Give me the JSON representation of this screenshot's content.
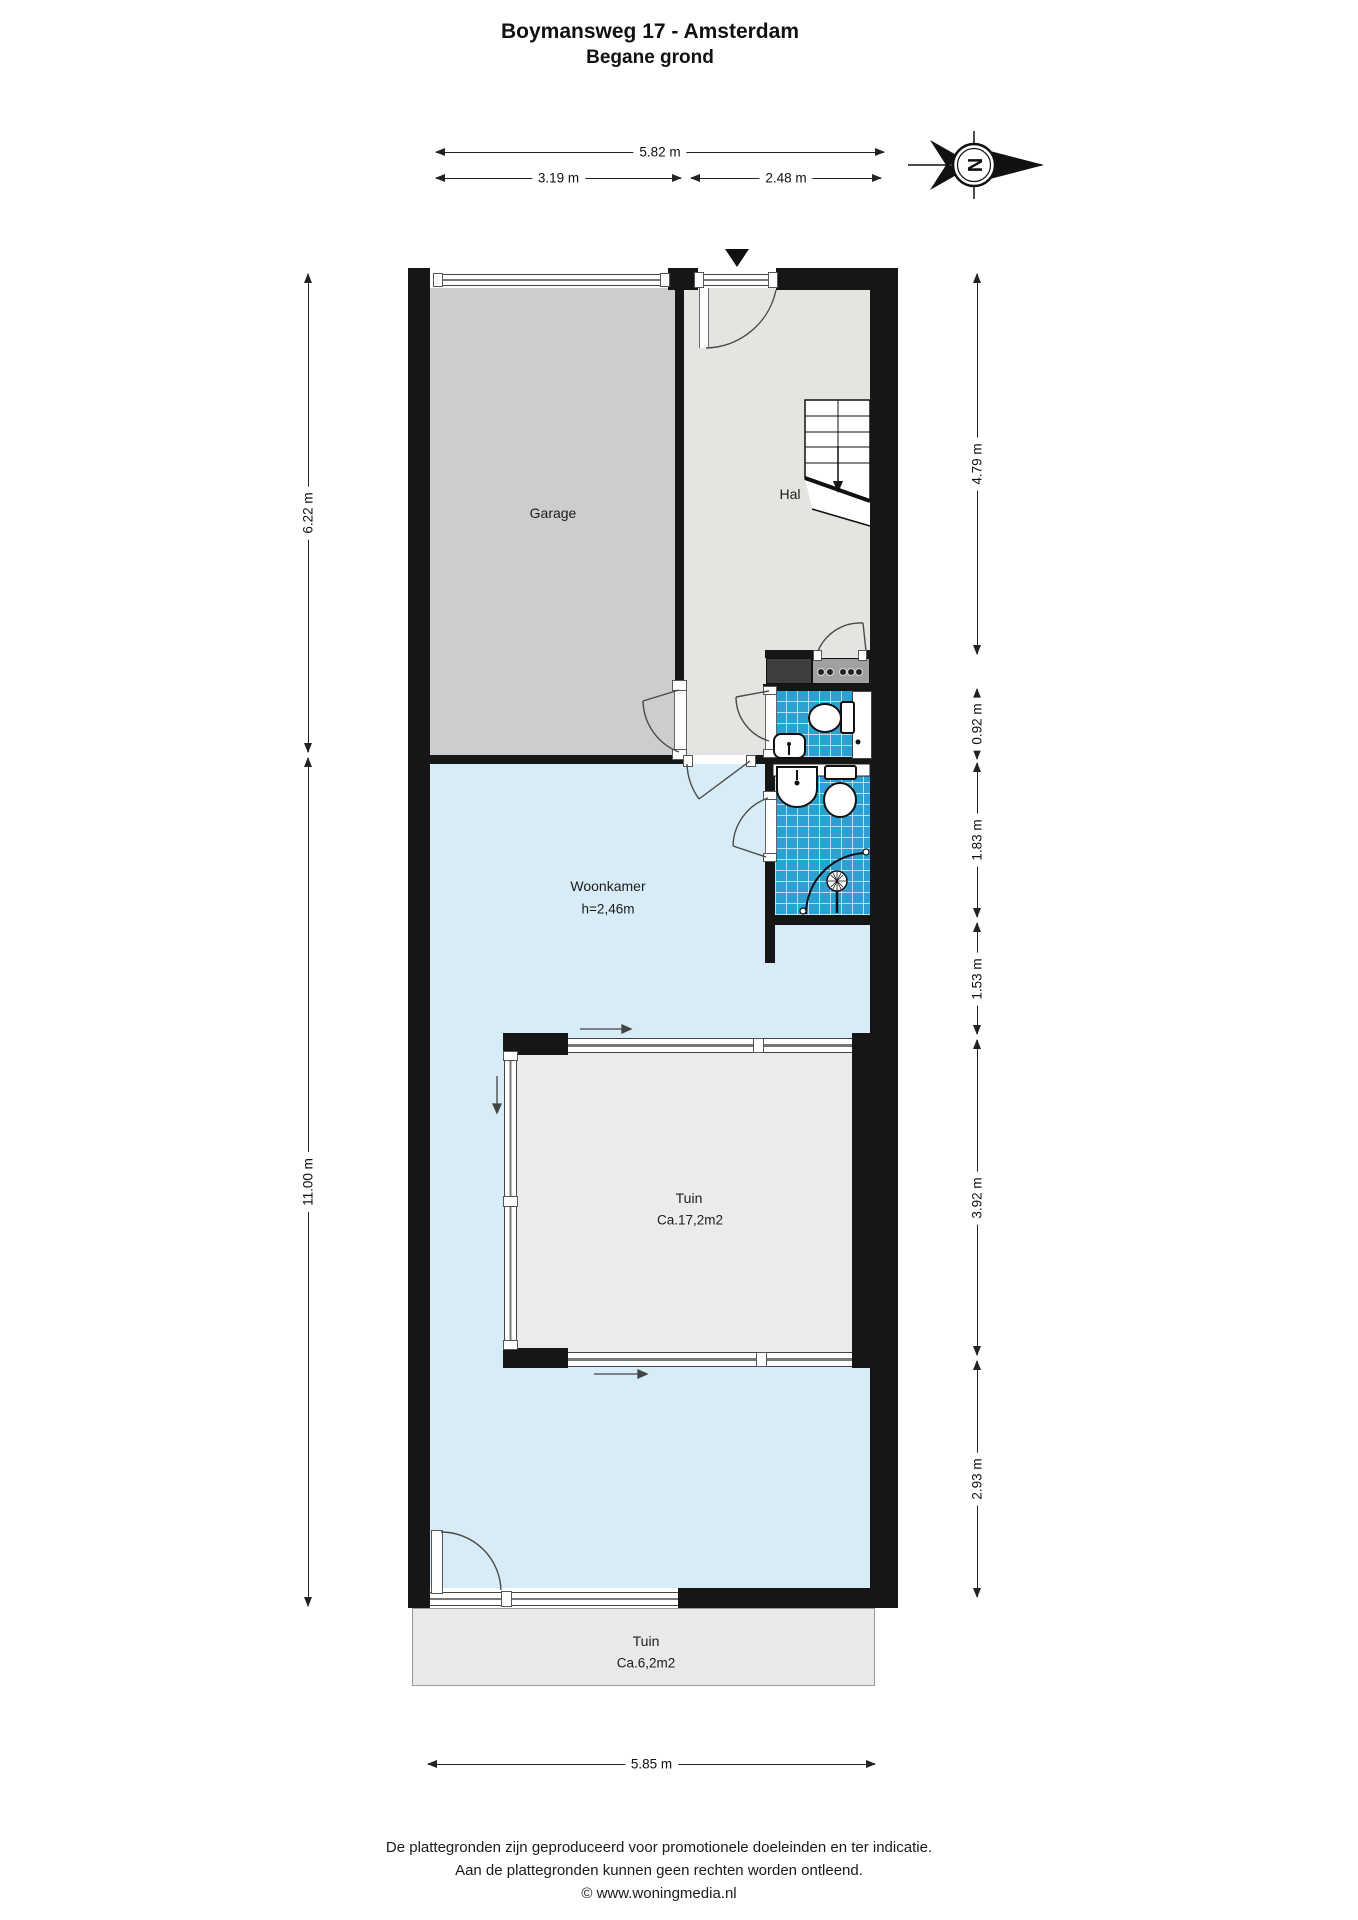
{
  "title": {
    "line1": "Boymansweg 17 - Amsterdam",
    "line2": "Begane grond"
  },
  "rooms": {
    "garage": {
      "label": "Garage"
    },
    "hal": {
      "label": "Hal"
    },
    "woonkamer": {
      "label": "Woonkamer",
      "height_note": "h=2,46m"
    },
    "tuin_inner": {
      "label": "Tuin",
      "area_note": "Ca.17,2m2"
    },
    "tuin_outer": {
      "label": "Tuin",
      "area_note": "Ca.6,2m2"
    }
  },
  "dimensions": {
    "top_total": "5.82 m",
    "top_left": "3.19 m",
    "top_right": "2.48 m",
    "left_upper": "6.22 m",
    "left_lower": "11.00 m",
    "right_1": "4.79 m",
    "right_2": "0.92 m",
    "right_3": "1.83 m",
    "right_4": "1.53 m",
    "right_5": "3.92 m",
    "right_6": "2.93 m",
    "bottom_total": "5.85 m"
  },
  "compass": {
    "letter": "N",
    "points_to": "right"
  },
  "footer": {
    "line1": "De plattegronden zijn geproduceerd voor promotionele doeleinden en ter indicatie.",
    "line2": "Aan de plattegronden kunnen geen rechten worden ontleend.",
    "line3": "© www.woningmedia.nl"
  },
  "colors": {
    "wall": "#161616",
    "garage_floor": "#cdcdcd",
    "hal_floor": "#e5e4e0",
    "woonkamer_floor": "#d8ecf7",
    "tuin_inner_floor": "#ebebe9",
    "tuin_outer_floor": "#e9e9e7",
    "bathroom_tile": "#2ba0d2",
    "counter_dark": "#3e3e3e",
    "counter_gray": "#a0a0a0"
  }
}
